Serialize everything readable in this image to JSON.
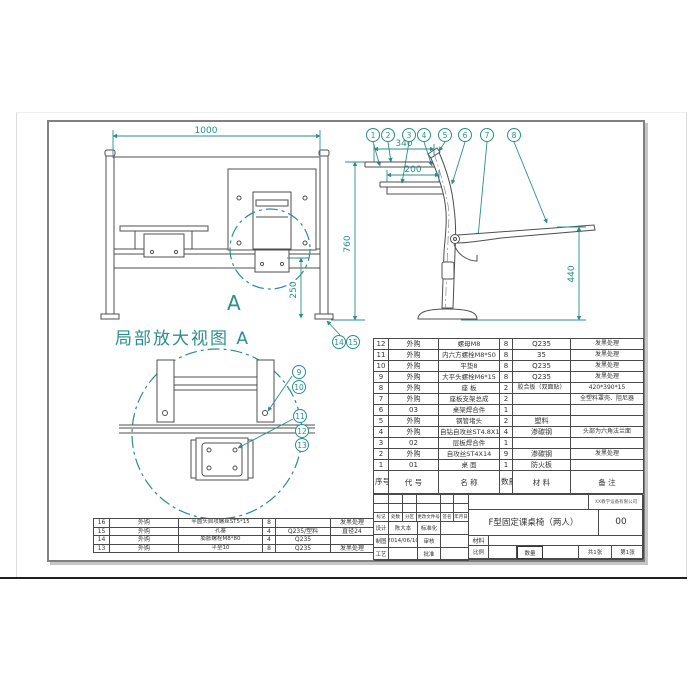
{
  "colors": {
    "accent_teal": "#2b8e8e",
    "line_gray": "#4f4f4f"
  },
  "front_view": {
    "dim_width": "1000",
    "dim_height": "760",
    "dim_foot": "250",
    "balloons": [
      "14",
      "15"
    ],
    "detail_mark": "A"
  },
  "detail_view": {
    "title": "局部放大视图 A",
    "balloons": [
      "9",
      "10",
      "11",
      "12",
      "13"
    ]
  },
  "side_view": {
    "dim_desk_depth": "340",
    "dim_shelf_depth": "200",
    "dim_seat_height": "440",
    "balloons": [
      "1",
      "2",
      "3",
      "4",
      "5",
      "6",
      "7",
      "8"
    ]
  },
  "bom": {
    "headers": {
      "seq": "序号",
      "code": "代  号",
      "name": "名  称",
      "qty": "数量",
      "material": "材  料",
      "remark": "备  注"
    },
    "rows_right": [
      {
        "seq": "12",
        "code": "外购",
        "name": "螺母M8",
        "qty": "8",
        "material": "Q235",
        "remark": "发黑处理"
      },
      {
        "seq": "11",
        "code": "外购",
        "name": "内六方螺栓M8*50",
        "qty": "8",
        "material": "35",
        "remark": "发黑处理"
      },
      {
        "seq": "10",
        "code": "外购",
        "name": "平垫8",
        "qty": "8",
        "material": "Q235",
        "remark": "发黑处理"
      },
      {
        "seq": "9",
        "code": "外购",
        "name": "大平头螺栓M6*15",
        "qty": "8",
        "material": "Q235",
        "remark": "发黑处理"
      },
      {
        "seq": "8",
        "code": "外购",
        "name": "座 板",
        "qty": "2",
        "material": "胶合板（双面贴）",
        "remark": "420*390*15"
      },
      {
        "seq": "7",
        "code": "外购",
        "name": "座板支架总成",
        "qty": "2",
        "material": "",
        "remark": "全塑料罩壳、阻尼器"
      },
      {
        "seq": "6",
        "code": "03",
        "name": "桌架焊合件",
        "qty": "1",
        "material": "",
        "remark": ""
      },
      {
        "seq": "5",
        "code": "外购",
        "name": "钢管堵头",
        "qty": "2",
        "material": "塑料",
        "remark": ""
      },
      {
        "seq": "4",
        "code": "外购",
        "name": "自钻自攻丝ST4.8X14",
        "qty": "4",
        "material": "渗碳钢",
        "remark": "头部为六角法兰面"
      },
      {
        "seq": "3",
        "code": "02",
        "name": "层板焊合件",
        "qty": "1",
        "material": "",
        "remark": ""
      },
      {
        "seq": "2",
        "code": "外购",
        "name": "自攻丝ST4X14",
        "qty": "9",
        "material": "渗碳钢",
        "remark": "发黑处理"
      },
      {
        "seq": "1",
        "code": "01",
        "name": "桌 面",
        "qty": "1",
        "material": "防火板",
        "remark": ""
      }
    ],
    "rows_left": [
      {
        "seq": "16",
        "code": "外购",
        "name": "半圆头自攻螺丝ST5*15",
        "qty": "8",
        "material": "",
        "remark": "发黑处理"
      },
      {
        "seq": "15",
        "code": "外购",
        "name": "孔塞",
        "qty": "4",
        "material": "Q235/塑料",
        "remark": "直径24"
      },
      {
        "seq": "14",
        "code": "外购",
        "name": "膨胀螺栓M8*80",
        "qty": "4",
        "material": "Q235",
        "remark": ""
      },
      {
        "seq": "13",
        "code": "外购",
        "name": "平垫10",
        "qty": "8",
        "material": "Q235",
        "remark": "发黑处理"
      }
    ]
  },
  "title_block": {
    "change_headers": [
      "标记",
      "处数",
      "分区",
      "更改文件号",
      "签名",
      "年月日"
    ],
    "design_label": "设计",
    "draft_label": "制图",
    "craft_label": "工艺",
    "designer": "陈大本",
    "date": "2014/06/10",
    "standard_label": "标准化",
    "audit_label": "审核",
    "approve_label": "批准",
    "company": "XX教学设备有限公司",
    "title": "F型固定课桌椅（两人）",
    "version": "00",
    "material_label": "材料",
    "scale_label": "比例",
    "qty_label": "数量",
    "sheet_total": "共1张",
    "sheet_no": "第1张"
  }
}
